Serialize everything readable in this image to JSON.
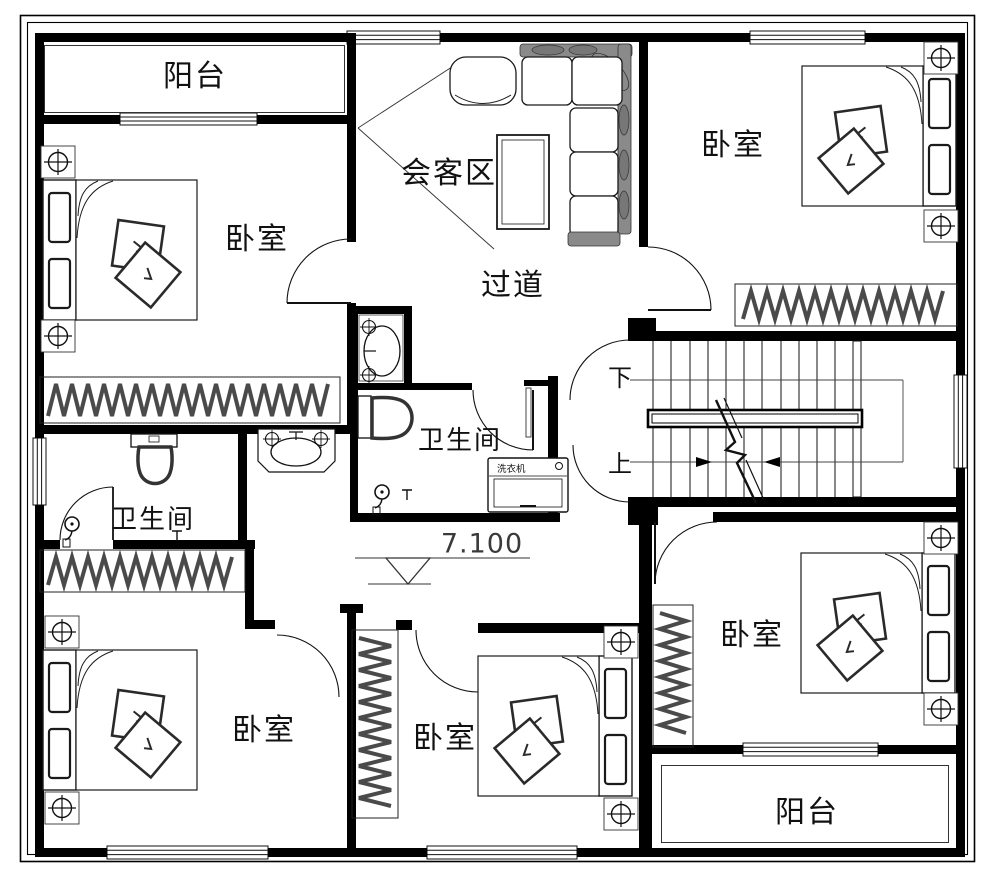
{
  "plan": {
    "labels": {
      "balcony_top": "阳台",
      "bedroom_top_left": "卧室",
      "reception": "会客区",
      "corridor": "过道",
      "bedroom_top_right": "卧室",
      "bathroom_left": "卫生间",
      "bathroom_middle": "卫生间",
      "stairs_down": "下",
      "stairs_up": "上",
      "elevation": "7.100",
      "bedroom_bottom_left": "卧室",
      "bedroom_bottom_middle": "卧室",
      "bedroom_bottom_right": "卧室",
      "balcony_bottom": "阳台",
      "washing_machine": "洗衣机"
    },
    "colors": {
      "wall": "#000000",
      "furniture_dark": "#4a4a4a",
      "sofa_fill": "#8a8a8a"
    }
  }
}
